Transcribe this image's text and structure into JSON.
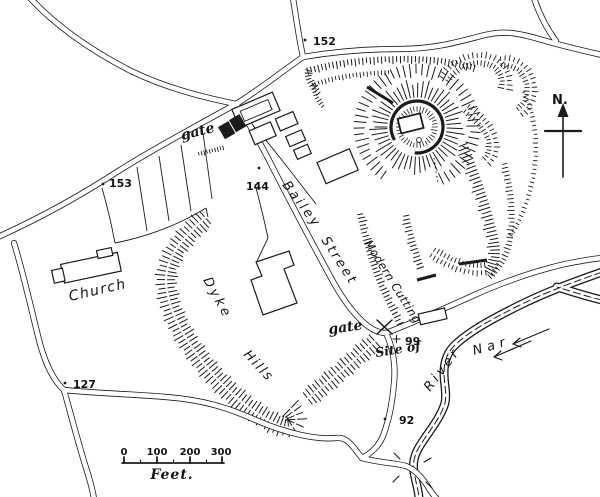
{
  "map": {
    "region_labels": {
      "church": "Church",
      "dyke_word1": "Dyke",
      "dyke_word2": "Hills",
      "street_word1": "Bailey",
      "street_word2": "Street",
      "modern_cutting": "Modern Cutting",
      "river_word1": "River",
      "river_word2": "Nar",
      "gate_north": "gate",
      "gate_south": "gate",
      "site_of": "Site of"
    },
    "spot_heights": [
      {
        "value": "152"
      },
      {
        "value": "153"
      },
      {
        "value": "144"
      },
      {
        "value": "127"
      },
      {
        "value": "99"
      },
      {
        "value": "92"
      }
    ],
    "compass": {
      "north_label": "N."
    },
    "scale_bar": {
      "tick_labels": [
        "0",
        "100",
        "200",
        "300"
      ],
      "unit_label": "Feet."
    },
    "colors": {
      "ink": "#1b1b1b",
      "paper": "#ffffff"
    }
  }
}
